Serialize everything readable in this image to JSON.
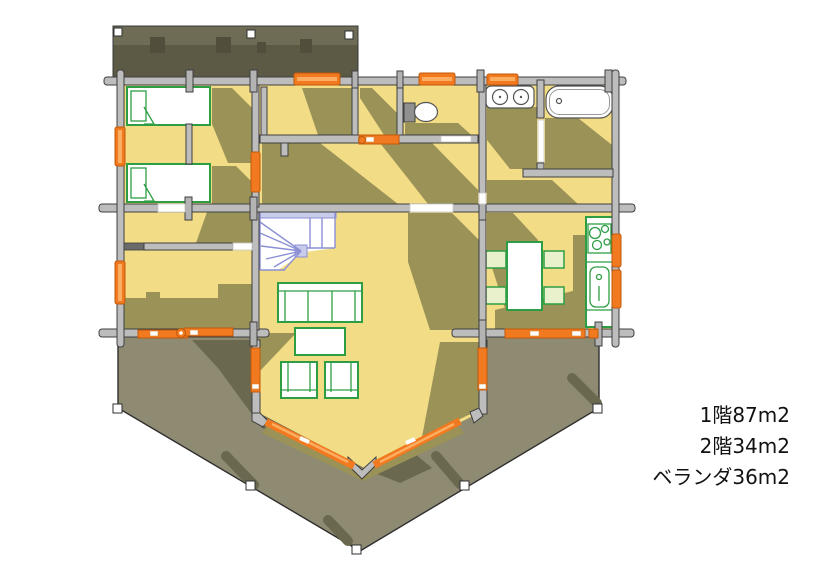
{
  "image": {
    "kind": "floor-plan",
    "width": 826,
    "height": 584
  },
  "labels": {
    "floor1_area": "1階87m2",
    "floor2_area": "2階34m2",
    "veranda_area": "ベランダ36m2"
  },
  "colors": {
    "floor": "#F2DC86",
    "floor-shadow": "#9A9257",
    "wall": "#BDBDBD",
    "wall-line": "#3F3F3F",
    "deck": "#8F8B73",
    "deck-shadow": "#6B6850",
    "upper-deck-top": "#6F6C55",
    "upper-deck-bottom": "#5C5944",
    "upper-deck-notch": "#514E3C",
    "window-orange": "#F1791F",
    "window-orange-dark": "#C2590A",
    "window-orange-light": "#FBAE62",
    "furniture-green": "#2E9E44",
    "stairs-line": "#8B8FD4",
    "stairs-fill": "#C9CBEA",
    "outline": "#2F2F2F",
    "text": "#111111"
  },
  "fixtures": [
    "upper-deck",
    "bed",
    "bed",
    "winder-stairs",
    "toilet",
    "double-sink-vanity",
    "bathtub",
    "sofa",
    "coffee-table",
    "armchair",
    "armchair",
    "dining-table",
    "dining-chairs",
    "kitchen-counter",
    "cooktop",
    "kitchen-sink",
    "veranda-deck"
  ]
}
